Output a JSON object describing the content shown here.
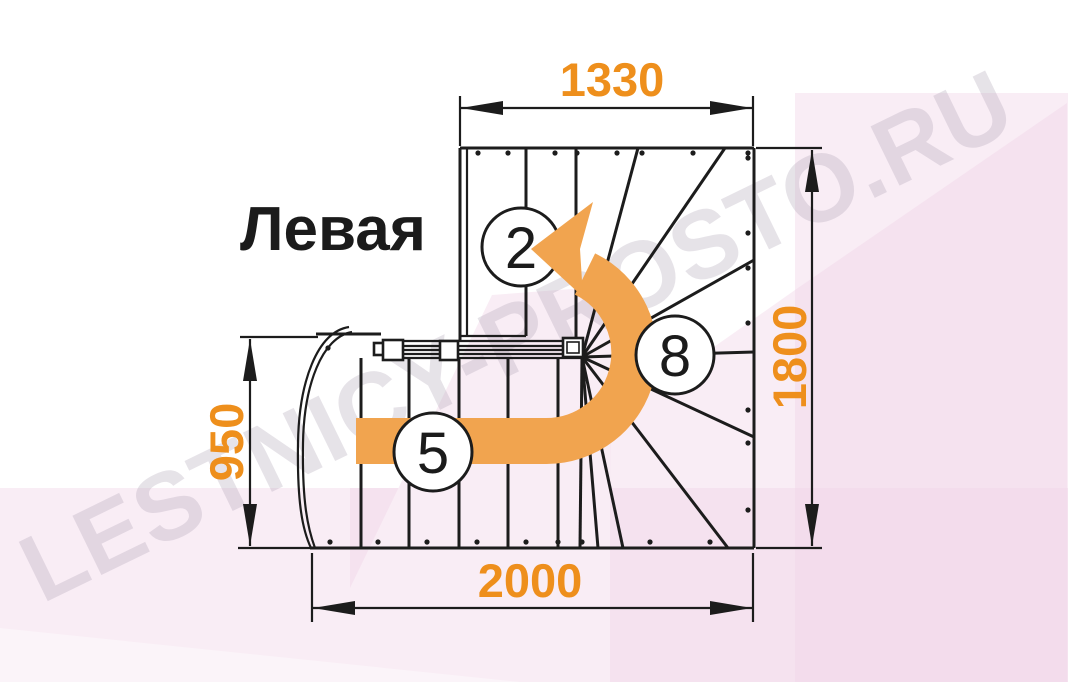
{
  "title": "Левая",
  "dimensions": {
    "top_width": "1330",
    "right_height": "1800",
    "left_height": "950",
    "bottom_width": "2000"
  },
  "step_markers": {
    "upper_flight": "2",
    "winder": "8",
    "lower_flight": "5"
  },
  "watermark": "LESTNICY-PROSTO.RU",
  "colors": {
    "dimension_orange": "#ee8f1c",
    "arrow_orange": "#f1a44f",
    "line_black": "#1c1c1c",
    "title_black": "#1b1b1b",
    "background_pink": "#f1d3e6",
    "watermark_gray": "#a99cb0"
  }
}
